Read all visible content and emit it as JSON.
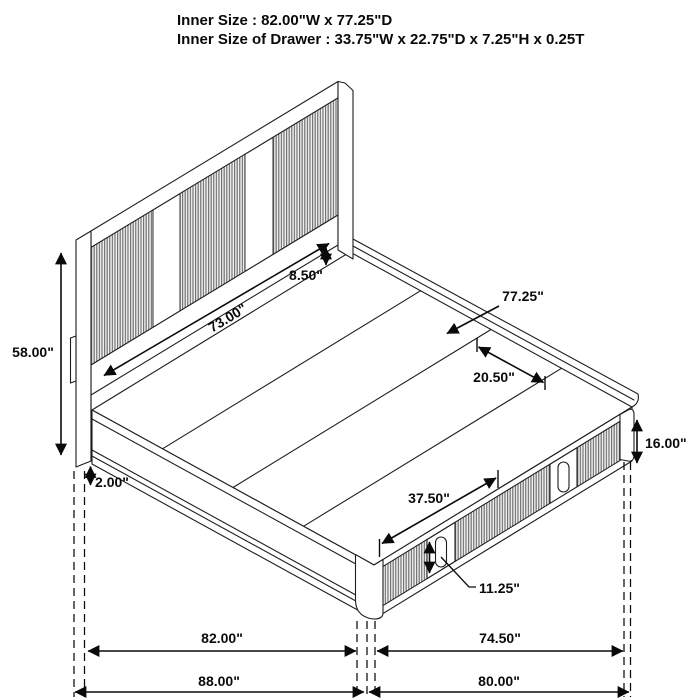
{
  "header": {
    "line1": "Inner Size : 82.00\"W x 77.25\"D",
    "line2": "Inner Size of Drawer : 33.75\"W x 22.75\"D x 7.25\"H x 0.25T"
  },
  "dimensions": {
    "headboard_height": "58.00\"",
    "leg_height": "2.00\"",
    "headboard_width": "73.00\"",
    "headboard_to_deck_gap": "8.50\"",
    "deck_depth": "77.25\"",
    "slat_width": "20.50\"",
    "platform_height": "16.00\"",
    "drawer_front_width": "37.50\"",
    "drawer_front_height": "11.25\"",
    "inner_width": "82.00\"",
    "footboard_inner_depth": "74.50\"",
    "outer_width": "88.00\"",
    "outer_depth": "80.00\""
  },
  "colors": {
    "line": "#1d1d1d",
    "dimension": "#0a0a0a",
    "rib_dark": "#6e6e6e",
    "rib_light": "#f0f0f0",
    "surface": "#ffffff",
    "background": "#ffffff"
  }
}
